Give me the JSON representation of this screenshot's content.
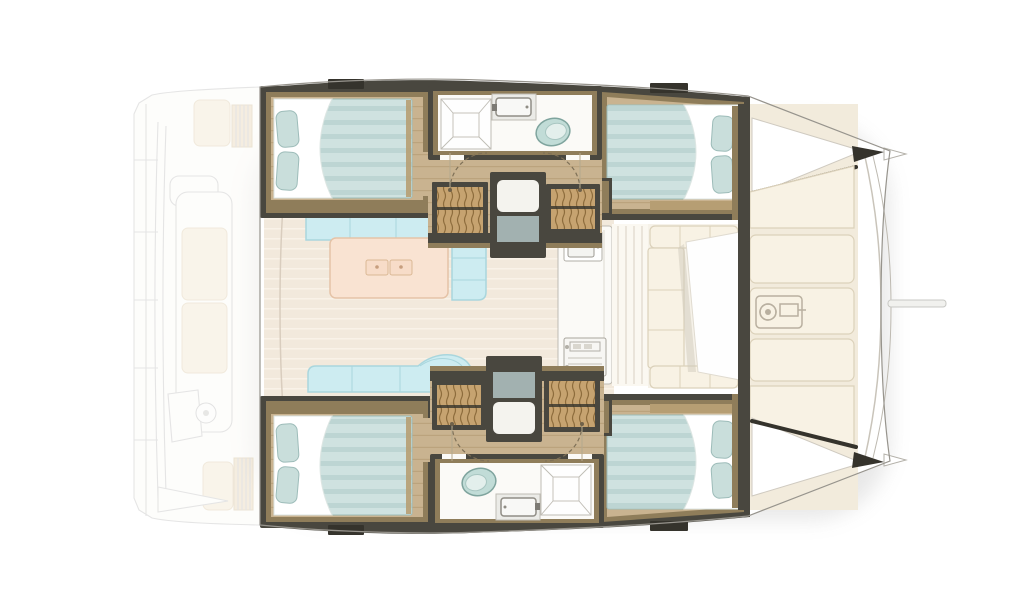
{
  "title": "Catamaran interior deck layout plan, bow to the right",
  "diagram_type": "yacht-floor-plan",
  "orientation": "bow-right",
  "areas": [
    "aft-cockpit-ghosted",
    "transom-steps-ghosted",
    "helm-station-ghosted",
    "saloon",
    "saloon-island-table",
    "galley",
    "galley-sink",
    "galley-stove",
    "forward-cockpit",
    "forward-cockpit-table",
    "port-aft-cabin",
    "port-forward-cabin",
    "starboard-aft-cabin",
    "starboard-forward-cabin",
    "port-bathroom",
    "starboard-bathroom",
    "port-stair-wells",
    "starboard-stair-wells",
    "companionway",
    "foredeck-sunpads",
    "anchor-windlass",
    "bow-points",
    "bowsprit"
  ],
  "counts": {
    "cabins": 4,
    "double_beds": 4,
    "bathrooms": 2,
    "showers": 2,
    "toilets": 2,
    "stair_wells": 4,
    "sunpad_sections": 5,
    "saloon_sofas": 2,
    "roof_hatches": 4
  },
  "colors": {
    "background": "#ffffff",
    "outline": "#97948d",
    "ghost_line": "#d4d4d4",
    "ghost_cushion": "#f6eedd",
    "ghost_step": "#efe2cc",
    "hull_wall": "#49473f",
    "hull_wall_dark": "#35332c",
    "wood_trim": "#8f7d5a",
    "wood_trim_light": "#b69e73",
    "cabin_floor": "#c9b390",
    "cabin_floor_line": "#ab9067",
    "deck_floor": "#f2e9dc",
    "deck_floor_line": "#f9f2e8",
    "corridor_floor": "#fbf8f1",
    "mattress": "#cfe2e0",
    "mattress_stripe": "#bdd5d3",
    "duvet": "#ffffff",
    "pillow": "#c9dedb",
    "pillow_edge": "#9dbcb9",
    "sofa": "#cdecf1",
    "sofa_edge": "#a9d6dd",
    "island": "#f9e3d2",
    "island_edge": "#e5c3a7",
    "counter": "#fbfaf7",
    "counter_edge": "#bfbcb4",
    "toilet": "#c1dcd7",
    "toilet_edge": "#7fa49e",
    "stair_base": "#c6a370",
    "stair_line": "#8d6c3c",
    "step_pad": "#a2b1b0",
    "sunpad": "#f8f2e4",
    "sunpad_edge": "#dbd1ba",
    "windlass": "#b9b0a0",
    "arc": "#7e7057",
    "shadow": "#8d8d8d"
  }
}
